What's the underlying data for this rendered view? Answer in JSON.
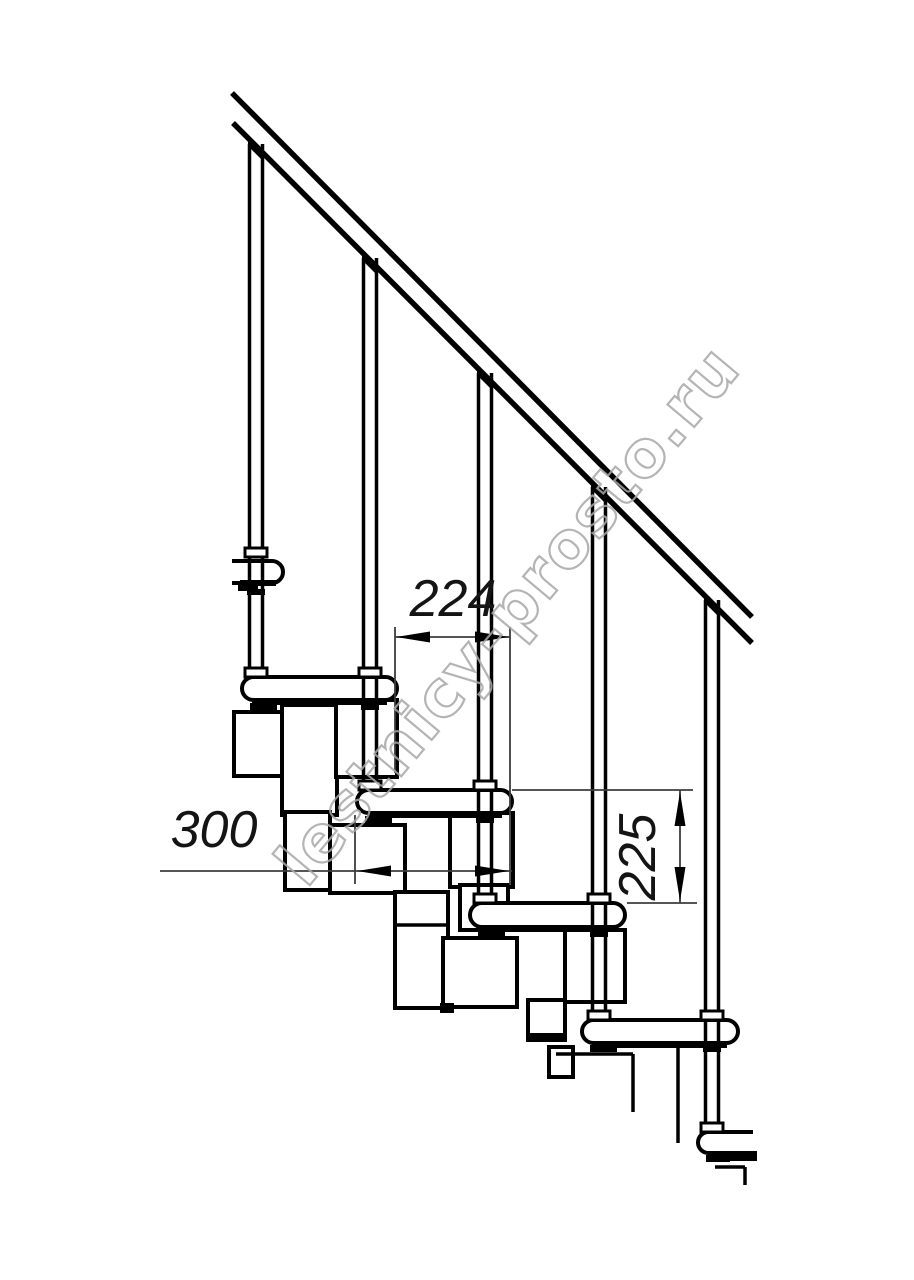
{
  "watermark_text": "lestnicy-prosto.ru",
  "dimensions": {
    "run": "224",
    "depth": "300",
    "rise": "225"
  },
  "colors": {
    "background": "#ffffff",
    "line": "#000000",
    "dim_line": "#3d3d3d",
    "dim_text": "#141414",
    "watermark": "#a8a8a8",
    "fill": "#ffffff"
  },
  "drawing": {
    "rail_lines": [
      [
        232,
        93,
        752,
        617
      ],
      [
        233,
        123,
        752,
        643
      ]
    ],
    "treads": [
      {
        "x": 232,
        "y": 561,
        "w": 51,
        "h": 22,
        "rl": false,
        "rr": true
      },
      {
        "x": 242,
        "y": 677,
        "w": 155,
        "h": 23,
        "rl": true,
        "rr": true
      },
      {
        "x": 357,
        "y": 790,
        "w": 155,
        "h": 23,
        "rl": true,
        "rr": true
      },
      {
        "x": 470,
        "y": 903,
        "w": 155,
        "h": 24,
        "rl": true,
        "rr": true
      },
      {
        "x": 582,
        "y": 1020,
        "w": 156,
        "h": 23,
        "rl": true,
        "rr": true
      },
      {
        "x": 698,
        "y": 1132,
        "w": 55,
        "h": 21,
        "rl": true,
        "rr": false
      }
    ],
    "strips": [
      [
        240,
        580,
        36,
        6
      ],
      [
        252,
        698,
        135,
        7
      ],
      [
        367,
        811,
        135,
        7
      ],
      [
        480,
        925,
        135,
        7
      ],
      [
        592,
        1041,
        135,
        7
      ],
      [
        708,
        1151,
        49,
        10
      ]
    ],
    "feet": [
      [
        238,
        585,
        20,
        6
      ],
      [
        250,
        703,
        27,
        7
      ],
      [
        365,
        816,
        27,
        7
      ],
      [
        478,
        929,
        27,
        7
      ],
      [
        590,
        1045,
        27,
        7
      ],
      [
        706,
        1155,
        24,
        7
      ]
    ],
    "modules": [
      {
        "x": 234,
        "y": 712,
        "w": 56,
        "h": 64
      },
      {
        "x": 282,
        "y": 705,
        "w": 55,
        "h": 110
      },
      {
        "x": 336,
        "y": 700,
        "w": 61,
        "h": 77
      },
      {
        "x": 285,
        "y": 812,
        "w": 45,
        "h": 78
      },
      {
        "x": 330,
        "y": 825,
        "w": 75,
        "h": 68
      },
      {
        "x": 450,
        "y": 813,
        "w": 63,
        "h": 74
      },
      {
        "x": 460,
        "y": 885,
        "w": 48,
        "h": 45
      },
      {
        "x": 395,
        "y": 892,
        "w": 53,
        "h": 116
      },
      {
        "x": 443,
        "y": 938,
        "w": 74,
        "h": 69
      },
      {
        "x": 565,
        "y": 930,
        "w": 60,
        "h": 72
      },
      {
        "x": 528,
        "y": 1000,
        "w": 37,
        "h": 40
      },
      {
        "x": 549,
        "y": 1047,
        "w": 24,
        "h": 30
      }
    ],
    "module_black": [
      [
        440,
        1003,
        14,
        10
      ],
      [
        528,
        1033,
        37,
        9
      ]
    ],
    "cut_lines": [
      [
        397,
        925,
        447,
        925
      ],
      [
        556,
        1054,
        633,
        1054
      ],
      [
        633,
        1054,
        633,
        1112
      ],
      [
        678,
        1045,
        678,
        1143
      ],
      [
        715,
        1167,
        745,
        1167
      ],
      [
        745,
        1167,
        745,
        1185
      ]
    ],
    "balusters": [
      {
        "cx": 256,
        "bot": 677
      },
      {
        "cx": 370,
        "bot": 790
      },
      {
        "cx": 485,
        "bot": 903
      },
      {
        "cx": 599,
        "bot": 1020
      },
      {
        "cx": 712,
        "bot": 1132
      }
    ],
    "rail_lower_ref": {
      "x0": 233,
      "y0": 123,
      "slope": 1.0
    },
    "flares": [
      [
        245,
        548
      ],
      [
        245,
        668
      ],
      [
        359,
        668
      ],
      [
        359,
        781
      ],
      [
        474,
        781
      ],
      [
        474,
        894
      ],
      [
        588,
        894
      ],
      [
        588,
        1011
      ],
      [
        701,
        1011
      ],
      [
        701,
        1123
      ]
    ],
    "connectors": [
      [
        247,
        589
      ],
      [
        361,
        704
      ],
      [
        476,
        817
      ],
      [
        590,
        931
      ],
      [
        703,
        1046
      ]
    ],
    "dim_ext_lines": [
      [
        395,
        627,
        395,
        773
      ],
      [
        510,
        627,
        510,
        885
      ],
      [
        355,
        815,
        355,
        884
      ],
      [
        512,
        790,
        693,
        790
      ],
      [
        627,
        903,
        697,
        903
      ]
    ],
    "dim_lines": [
      [
        395,
        637,
        510,
        637
      ],
      [
        160,
        871,
        512,
        871
      ],
      [
        680,
        790,
        680,
        903
      ]
    ],
    "dim_arrows": [
      {
        "x": 396,
        "y": 637,
        "dir": "left"
      },
      {
        "x": 509,
        "y": 637,
        "dir": "right"
      },
      {
        "x": 357,
        "y": 871,
        "dir": "left"
      },
      {
        "x": 509,
        "y": 871,
        "dir": "right"
      },
      {
        "x": 680,
        "y": 792,
        "dir": "up"
      },
      {
        "x": 680,
        "y": 901,
        "dir": "down"
      }
    ],
    "stroke": {
      "main": 4,
      "baluster": 3.5,
      "rail": 5.5,
      "cut": 3.5,
      "dim": 1.8
    }
  }
}
